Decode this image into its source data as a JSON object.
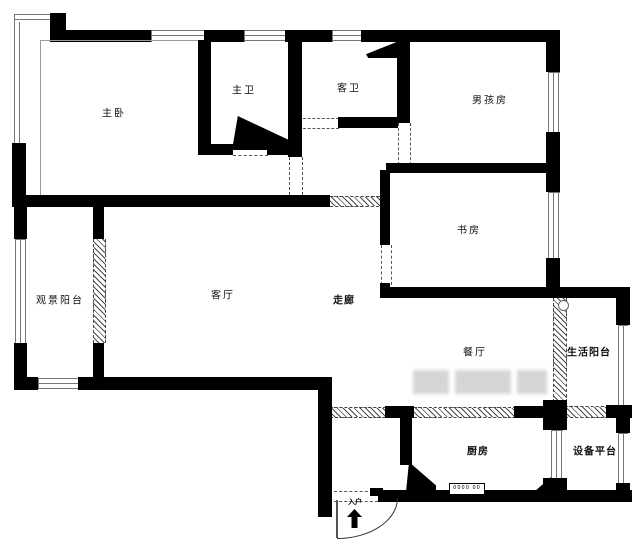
{
  "plan": {
    "type": "apartment-floor-plan",
    "colors": {
      "wall": "#000000",
      "window_line": "#777777",
      "hatch_line": "#4a4a4a",
      "background": "#ffffff"
    },
    "rooms": [
      {
        "id": "master-bedroom",
        "label": "主卧"
      },
      {
        "id": "master-bathroom",
        "label": "主卫"
      },
      {
        "id": "guest-bathroom",
        "label": "客卫"
      },
      {
        "id": "boys-room",
        "label": "男孩房"
      },
      {
        "id": "study",
        "label": "书房"
      },
      {
        "id": "view-balcony",
        "label": "观景阳台"
      },
      {
        "id": "living-room",
        "label": "客厅"
      },
      {
        "id": "corridor",
        "label": "走廊"
      },
      {
        "id": "dining-room",
        "label": "餐厅"
      },
      {
        "id": "life-balcony",
        "label": "生活阳台"
      },
      {
        "id": "kitchen",
        "label": "厨房"
      },
      {
        "id": "equipment-platform",
        "label": "设备平台"
      },
      {
        "id": "entry",
        "label": "入户"
      }
    ],
    "symbols": {
      "stove": "0000 00",
      "entry_arrow": "↑"
    }
  }
}
